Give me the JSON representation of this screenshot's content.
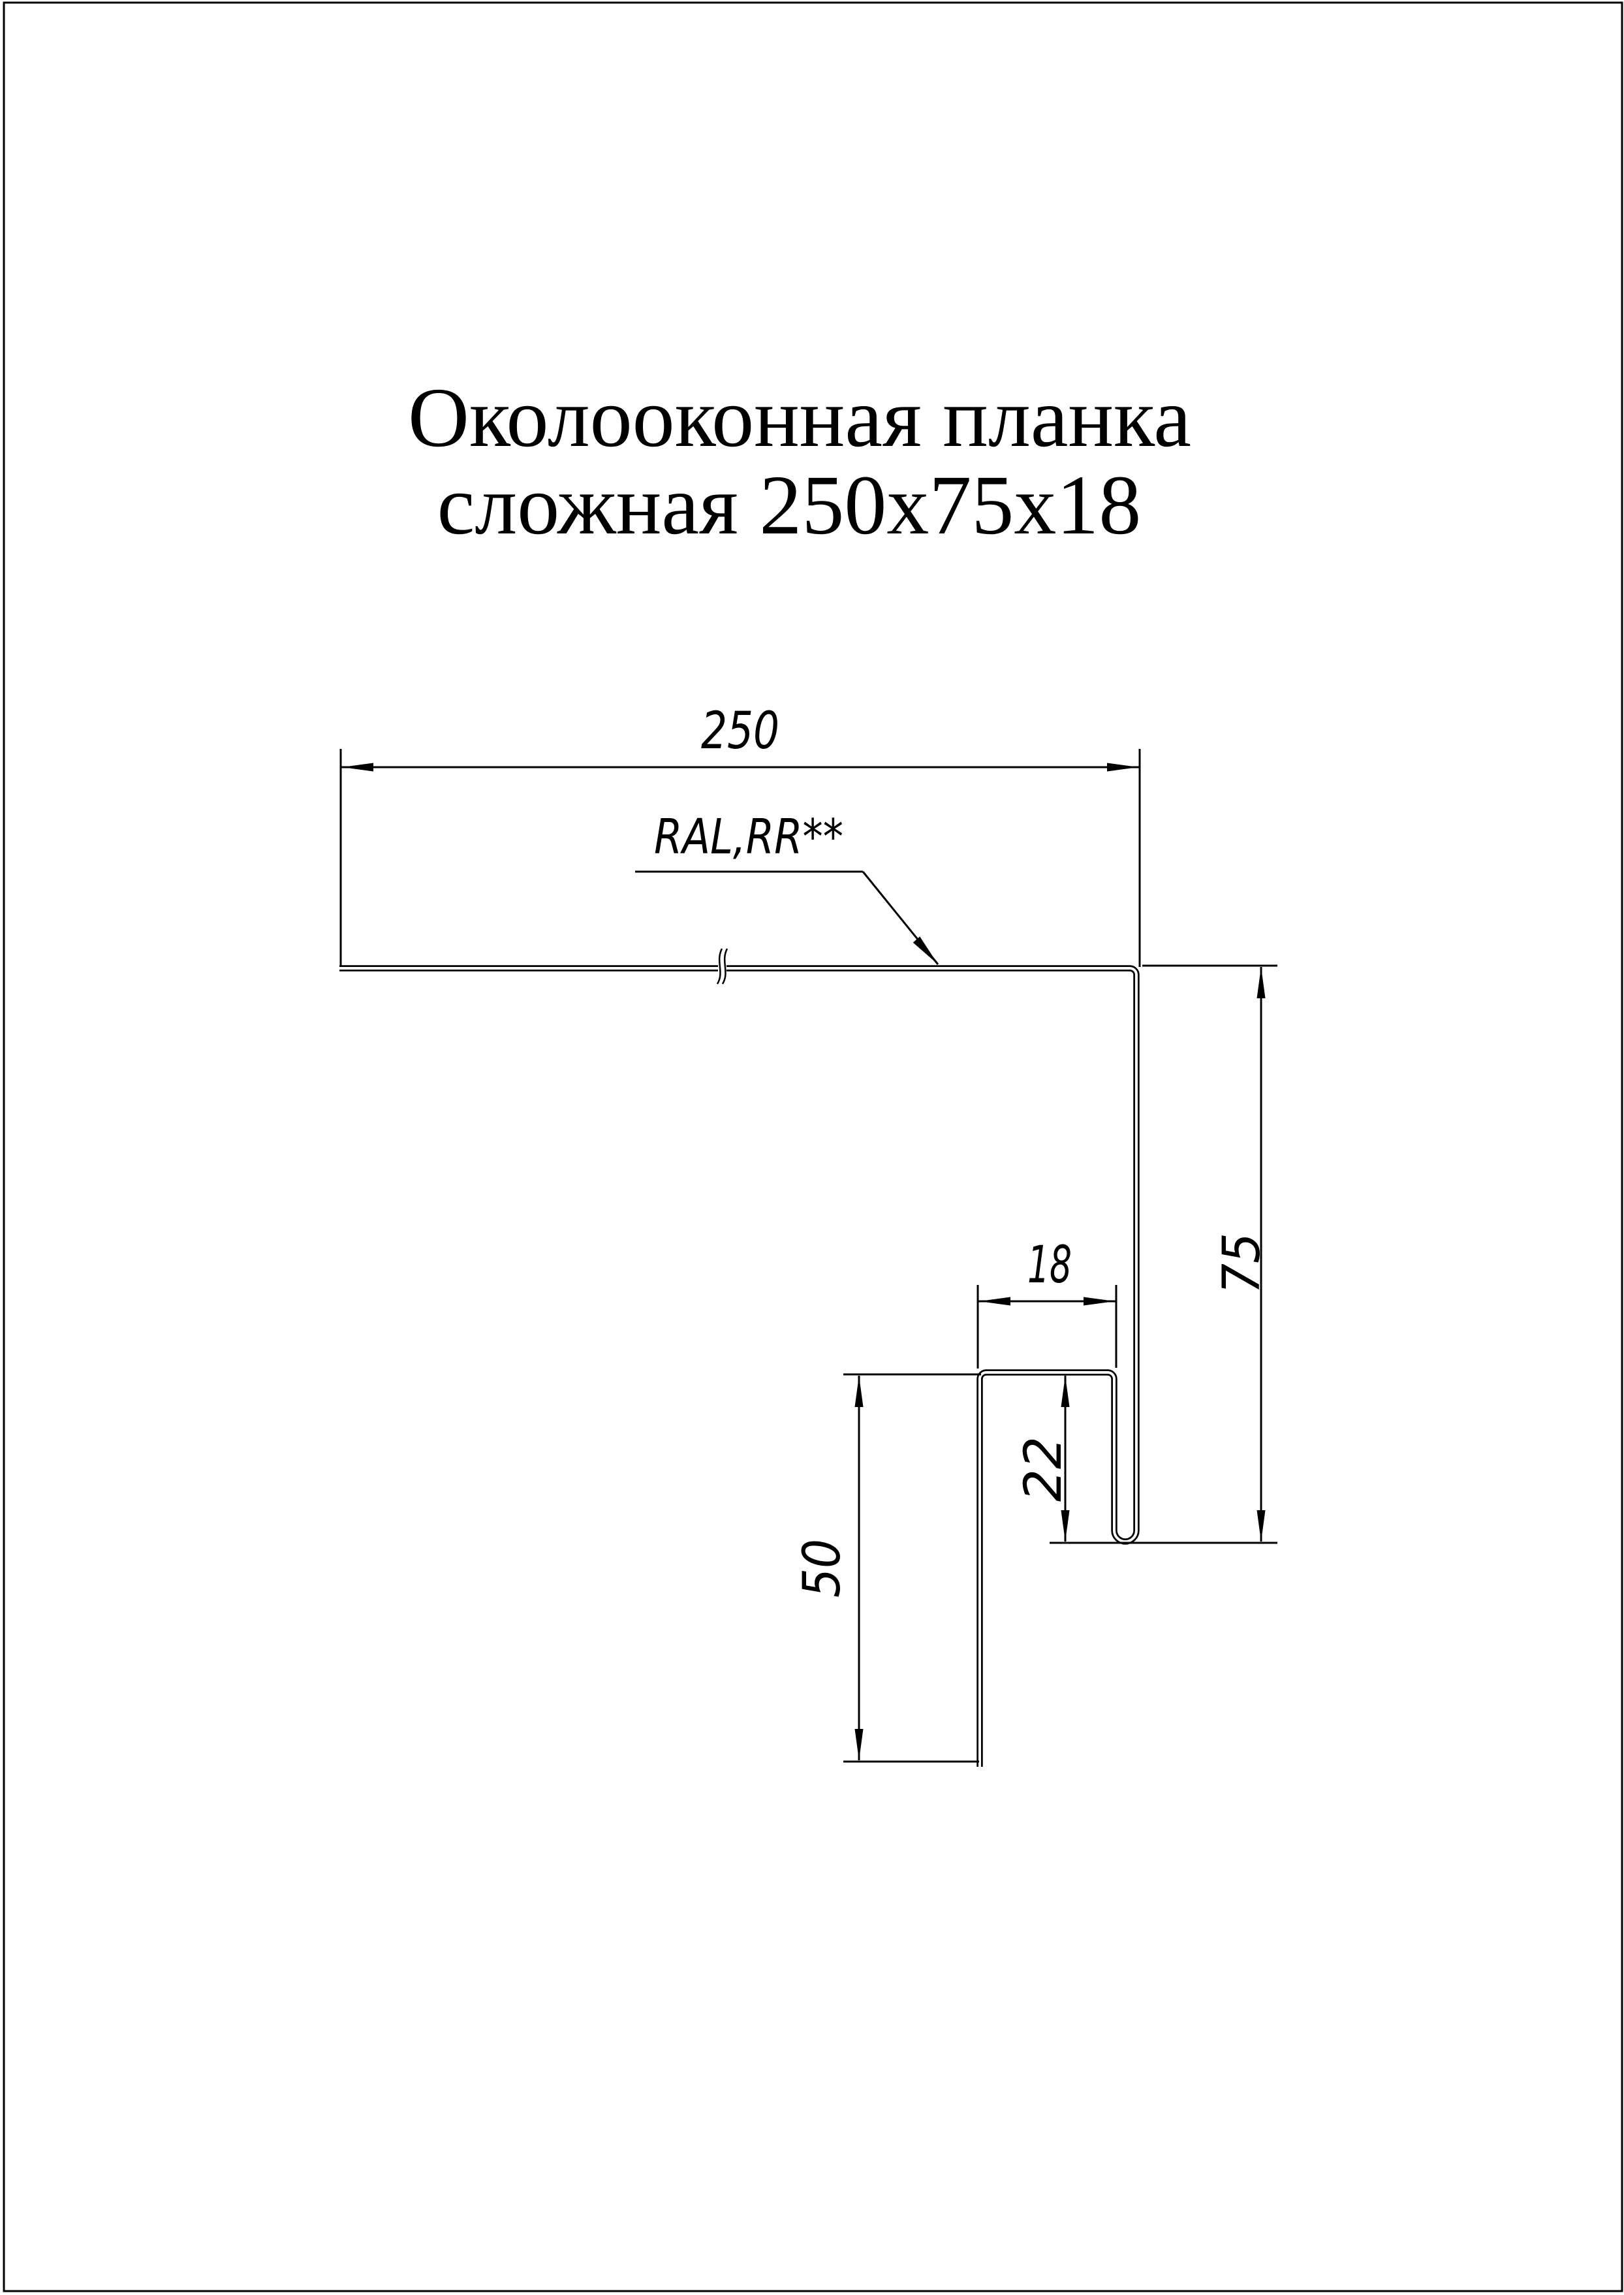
{
  "page": {
    "background": "#ffffff",
    "ink": "#000000"
  },
  "title": {
    "line1": "Околооконная планка",
    "line2": "сложная 250х75х18"
  },
  "callout": {
    "coating_label": "RAL,RR**"
  },
  "dimensions": {
    "flange_width": "250",
    "side_height": "75",
    "hook_width": "18",
    "hook_height": "22",
    "leg_length": "50"
  }
}
